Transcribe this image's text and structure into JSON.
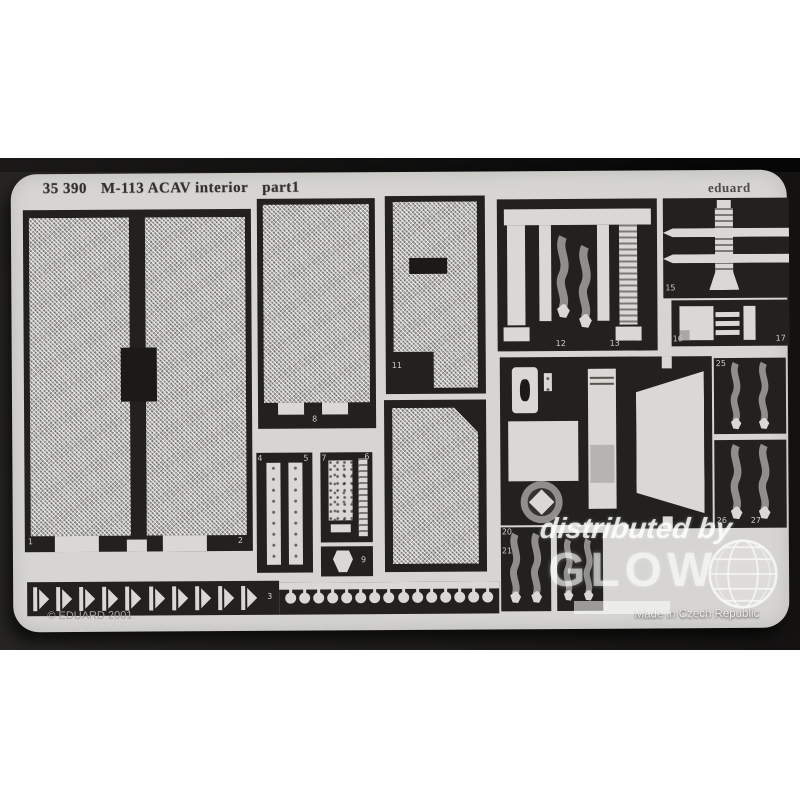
{
  "photo": {
    "header": {
      "catalog": "35 390",
      "title": "M-113 ACAV interior",
      "part": "part1",
      "brand": "eduard"
    },
    "footer": {
      "copyright": "© EDUARD 2001",
      "made_in": "Made in Czech Republic"
    },
    "watermark": {
      "line1": "distributed by",
      "line2": "GLOW",
      "icon": "globe-icon"
    },
    "part_labels": {
      "p1": "1",
      "p2": "2",
      "p3": "3",
      "p4": "4",
      "p5": "5",
      "p6": "6",
      "p7": "7",
      "p8": "8",
      "p9": "9",
      "p11": "11",
      "p12": "12",
      "p13": "13",
      "p15": "15",
      "p16": "16",
      "p17": "17",
      "p20": "20",
      "p21": "21",
      "p25": "25",
      "p26": "26",
      "p27": "27"
    },
    "repeat": {
      "hinge_count": 10,
      "rivet_count": 15
    },
    "colors": {
      "backdrop": "#1d1c1a",
      "fret": "#d6d5d1",
      "opening": "#22211e",
      "mesh": "#bcbbb7",
      "part": "#d9d8d4",
      "belt": "#8f8e8a",
      "watermark": "#ffffff"
    }
  }
}
